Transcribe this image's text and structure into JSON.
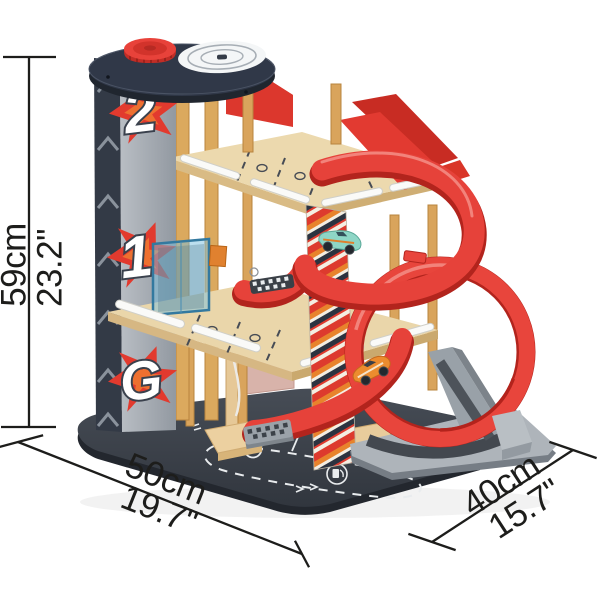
{
  "alt": "Wooden toy race parking garage with helipad, three levels, spiral ramp, loop track and toy cars, shown with product dimension annotations",
  "annotations": {
    "height_cm": "59cm",
    "height_in": "23.2\"",
    "width_cm": "50cm",
    "width_in": "19.7\"",
    "depth_cm": "40cm",
    "depth_in": "15.7\""
  },
  "product": {
    "brand": "Hape",
    "levels": [
      "2",
      "1",
      "G"
    ],
    "parking_symbol": "P"
  },
  "colors": {
    "accent_red": "#e2392f",
    "orange": "#e8832c",
    "wood": "#ead6aa",
    "dowel_wood": "#d9a45c",
    "charcoal_base": "#3a3f47",
    "tower_gray": "#a9aeb5",
    "navy_cap": "#2e3644",
    "plastic_gray": "#aeb4ba",
    "teal_car": "#8ed6c6",
    "orange_car": "#ec8c2e",
    "annotation_black": "#1d1d1b"
  }
}
